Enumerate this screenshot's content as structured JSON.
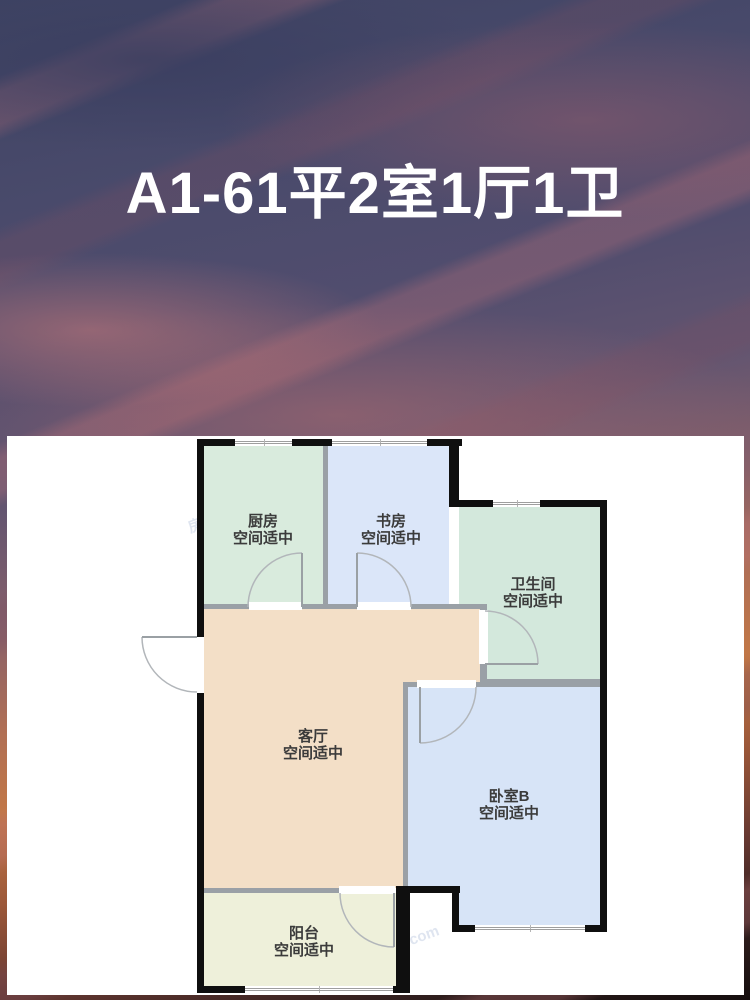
{
  "title": {
    "text": "A1-61平2室1厅1卫"
  },
  "floorplan": {
    "watermark": "房天下fang.com",
    "rooms": [
      {
        "id": "kitchen",
        "name": "厨房",
        "status": "空间适中",
        "color": "#d9ebdd"
      },
      {
        "id": "study",
        "name": "书房",
        "status": "空间适中",
        "color": "#dbe6f9"
      },
      {
        "id": "bathroom",
        "name": "卫生间",
        "status": "空间适中",
        "color": "#d3e8dc"
      },
      {
        "id": "living",
        "name": "客厅",
        "status": "空间适中",
        "color": "#f3dfc7"
      },
      {
        "id": "bedroomB",
        "name": "卧室B",
        "status": "空间适中",
        "color": "#d7e4f7"
      },
      {
        "id": "balcony",
        "name": "阳台",
        "status": "空间适中",
        "color": "#eef0da"
      }
    ]
  }
}
